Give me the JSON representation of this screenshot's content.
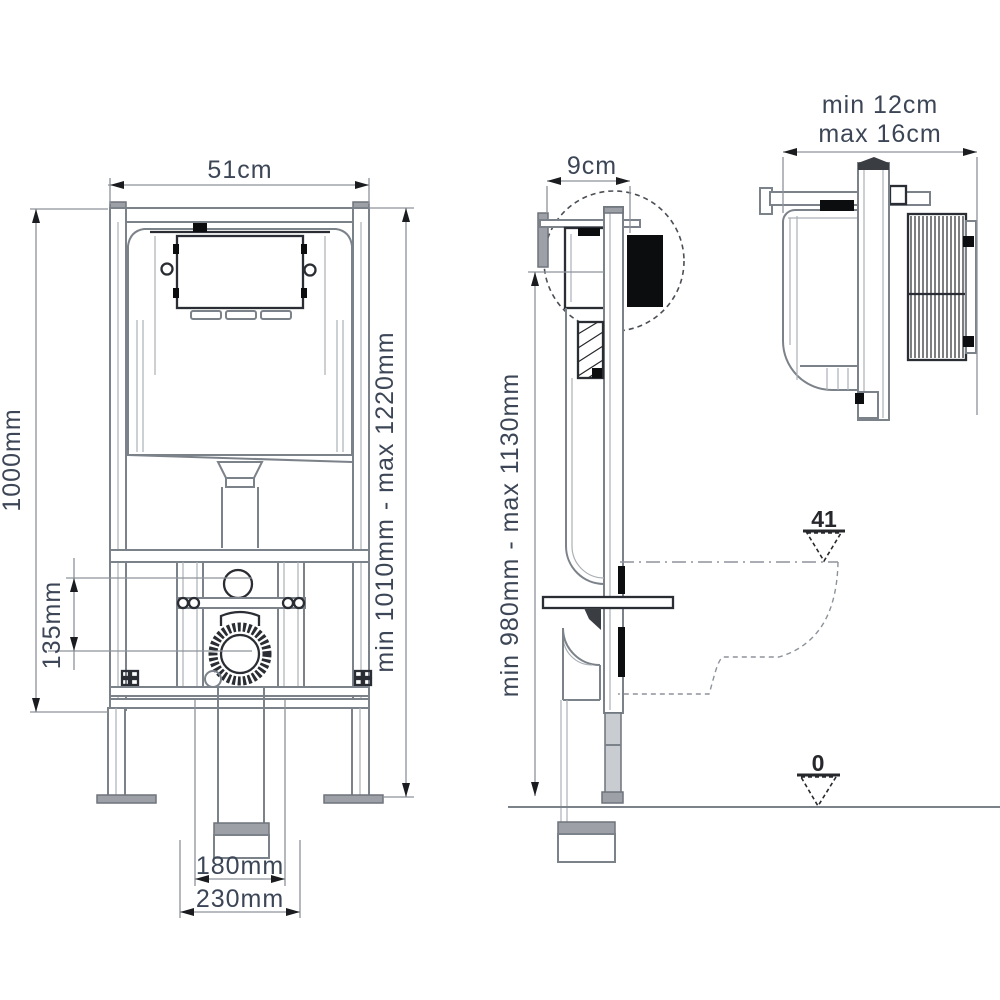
{
  "drawing": {
    "kind": "wc-concealed-cistern-frame-installation-diagram",
    "background": "#ffffff",
    "colors": {
      "text": "#3c4656",
      "line_light": "#aab0b6",
      "line_mid": "#7c828a",
      "line_dark": "#2a2d33",
      "fill_black": "#0c0d0f"
    },
    "views": {
      "front": {
        "name": "front view",
        "width_label": "51cm",
        "frame_height_label": "1000mm",
        "adjustable_height_label": "min 1010mm - max 1220mm",
        "inlet_to_waste_offset_label": "135mm",
        "waste_inner_label": "180mm",
        "waste_outer_label": "230mm"
      },
      "side": {
        "name": "side view",
        "depth_label": "9cm",
        "adjustable_height_label": "min 980mm - max 1130mm",
        "seat_level_value": "41",
        "floor_level_value": "0"
      },
      "detail": {
        "name": "wall thickness detail",
        "range_line1": "min 12cm",
        "range_line2": "max 16cm"
      }
    }
  }
}
